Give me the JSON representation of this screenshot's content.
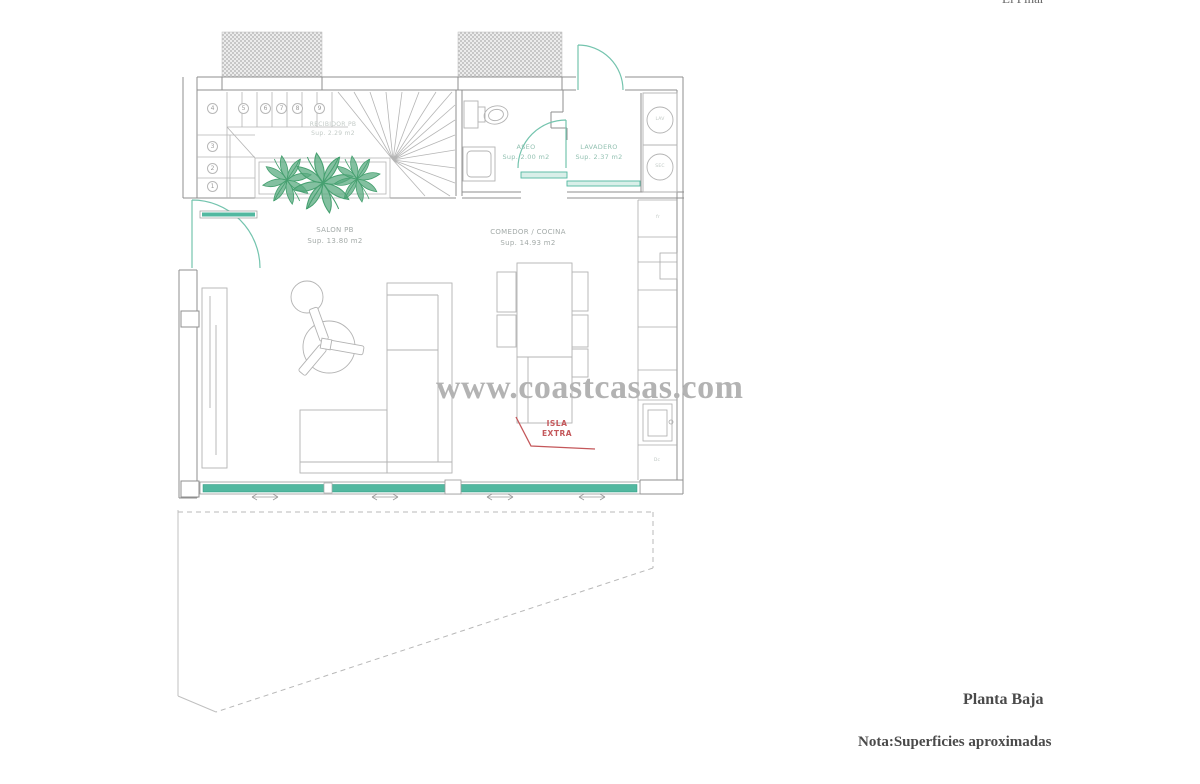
{
  "header": {
    "top_right_partial": "El Pinar"
  },
  "watermark": {
    "text": "www.coastcasas.com"
  },
  "footer": {
    "title": "Planta Baja",
    "note": "Nota:Superficies aproximadas"
  },
  "rooms": {
    "recibidor": {
      "name": "RECIBIDOR PB",
      "area": "Sup. 2.29 m2"
    },
    "aseo": {
      "name": "ASEO",
      "area": "Sup. 2.00 m2"
    },
    "lavadero": {
      "name": "LAVADERO",
      "area": "Sup. 2.37 m2"
    },
    "salon": {
      "name": "SALON PB",
      "area": "Sup. 13.80 m2"
    },
    "comedor": {
      "name": "COMEDOR / COCINA",
      "area": "Sup. 14.93 m2"
    }
  },
  "annotations": {
    "island_line1": "ISLA",
    "island_line2": "EXTRA"
  },
  "stairs": {
    "top_row": [
      "4",
      "5",
      "6",
      "7",
      "8",
      "9"
    ],
    "left_column": [
      "3",
      "2",
      "1"
    ]
  },
  "appliances": {
    "washer": "LAV",
    "dryer": "SEC",
    "fridge": "fr",
    "base_unit": "Dc"
  },
  "colors": {
    "teal": "#52b8a0",
    "teal_light": "#74c4ae",
    "plant_green": "#46a070",
    "red": "#c4575a",
    "wall_gray": "#8f8f8f",
    "line_gray": "#b3b3b3",
    "watermark_gray": "#b3b3b3",
    "text_dark": "#4a4a4a"
  }
}
